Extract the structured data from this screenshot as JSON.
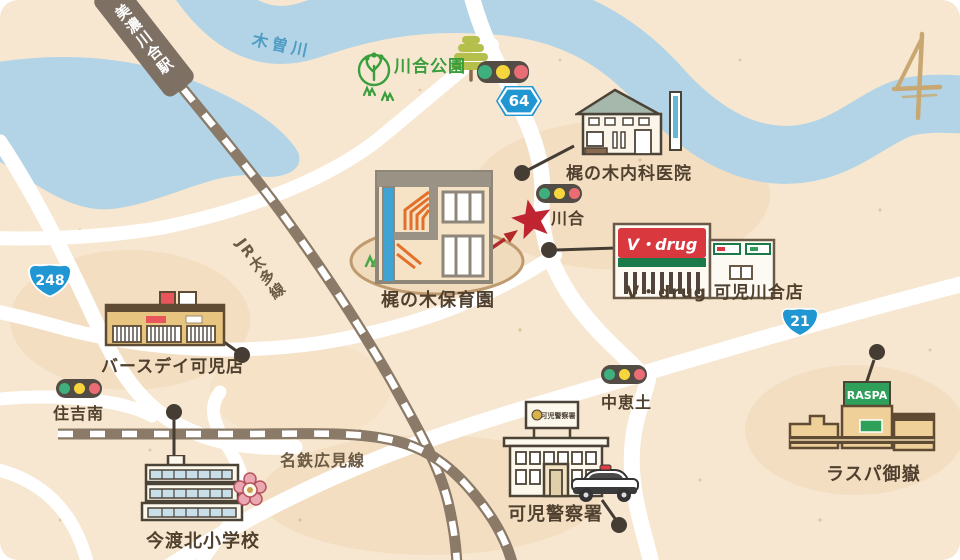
{
  "map": {
    "river": {
      "name": "木曽川"
    },
    "station": {
      "name": "美濃川合駅"
    },
    "rail_lines": [
      {
        "name": "JR太多線"
      },
      {
        "name": "名鉄広見線"
      }
    ],
    "park": {
      "name": "川合公園"
    },
    "route_badges": [
      {
        "number": "64"
      },
      {
        "number": "248"
      },
      {
        "number": "21"
      }
    ],
    "intersections": [
      {
        "name": "川合"
      },
      {
        "name": "住吉南"
      },
      {
        "name": "中恵土"
      }
    ],
    "destination": {
      "name": "梶の木保育園"
    },
    "landmarks": [
      {
        "name": "梶の木内科医院"
      },
      {
        "name": "V・drug 可児川合店"
      },
      {
        "name": "バースデイ可児店"
      },
      {
        "name": "今渡北小学校"
      },
      {
        "name": "可児警察署"
      },
      {
        "name": "ラスパ御嶽"
      }
    ],
    "building_signs": {
      "vdrug": "V・drug",
      "raspa": "RASPA",
      "police": "可児警察署"
    },
    "colors": {
      "background": "#f7e7d0",
      "river": "#b2d4e6",
      "road": "#ffffff",
      "rail": "#8a7a67",
      "label": "#50402e",
      "park_green": "#3a9e3c",
      "badge_blue": "#2097d3",
      "star_red": "#bf2430",
      "signal_green": "#3faf7e",
      "signal_yellow": "#f6d63c",
      "signal_red": "#ea6d76"
    }
  }
}
